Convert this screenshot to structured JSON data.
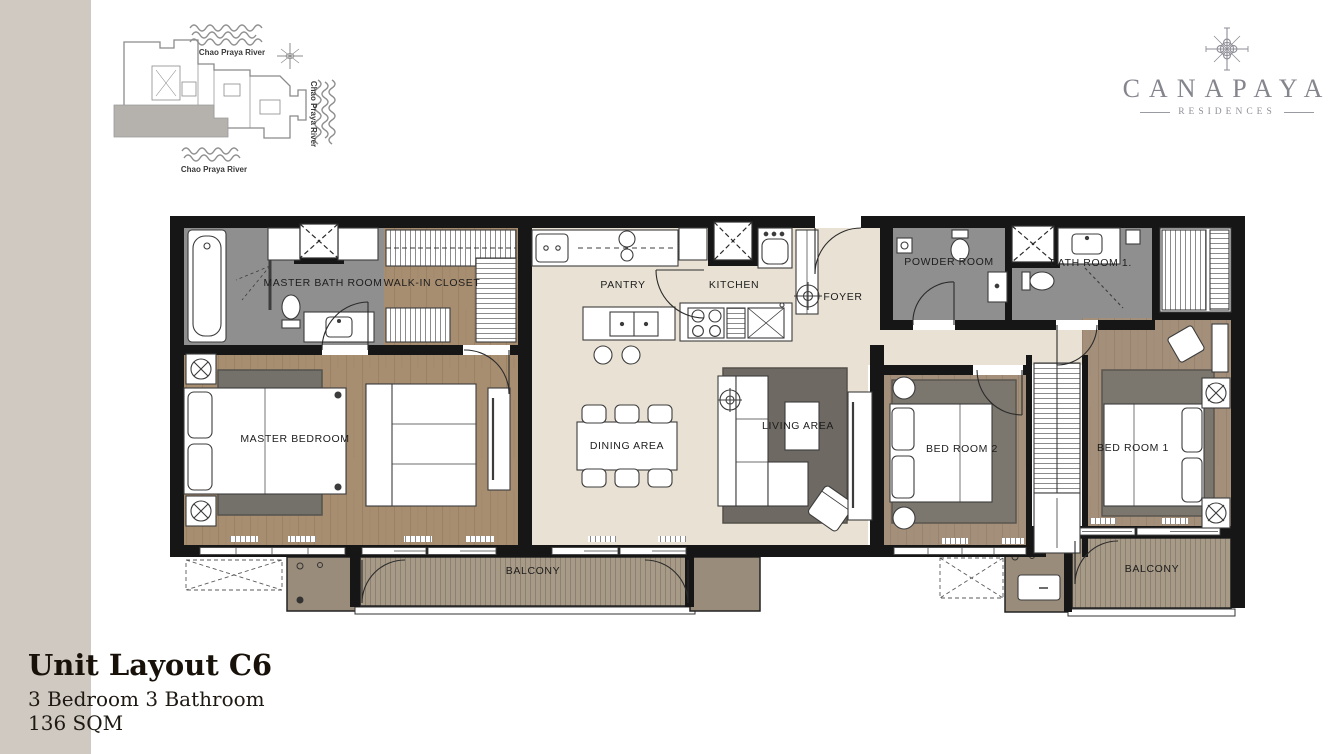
{
  "site_plan": {
    "river_top": "Chao Praya River",
    "river_right": "Chao Praya River",
    "river_bottom": "Chao Praya River"
  },
  "logo": {
    "brand": "CANAPAYA",
    "subtitle": "RESIDENCES"
  },
  "floor_plan": {
    "rooms": {
      "master_bath": "MASTER BATH ROOM",
      "walk_in_closet": "WALK-IN CLOSET",
      "pantry": "PANTRY",
      "kitchen": "KITCHEN",
      "foyer": "FOYER",
      "powder_room": "POWDER ROOM",
      "bath_room_1": "BATH ROOM 1.",
      "master_bedroom": "MASTER BEDROOM",
      "dining_area": "DINING AREA",
      "living_area": "LIVING AREA",
      "bed_room_2": "BED ROOM 2",
      "bed_room_1": "BED ROOM 1",
      "balcony_main": "BALCONY",
      "balcony_right": "BALCONY"
    }
  },
  "title_block": {
    "title": "Unit Layout C6",
    "subtitle": "3 Bedroom 3 Bathroom",
    "area": "136 SQM"
  },
  "colors": {
    "wall": "#161616",
    "wood_floor": "#a78e71",
    "bathroom_floor": "#8f8f8f",
    "living_floor": "#e9e2d4",
    "balcony_deck": "#a79a86",
    "ac_closet": "#9a8c7b",
    "rug": "#6e6a63",
    "left_stripe": "#cfc9c2",
    "logo_gray": "#85858e"
  }
}
